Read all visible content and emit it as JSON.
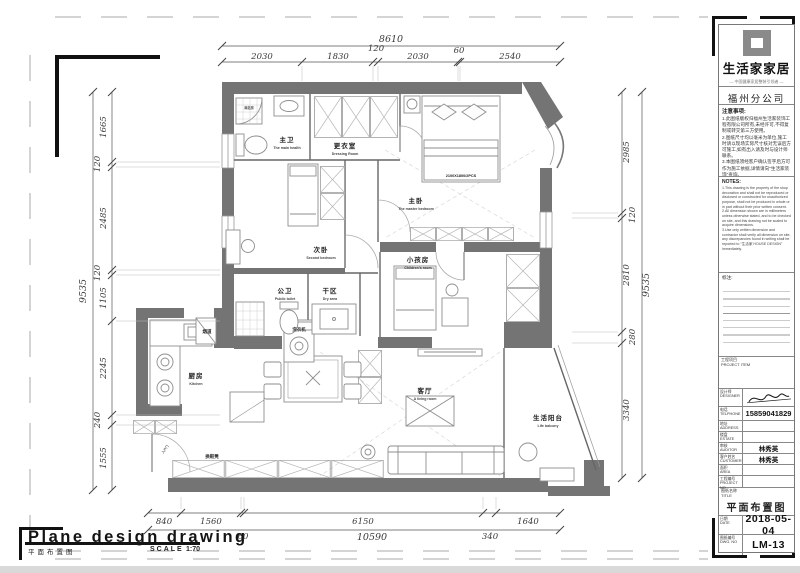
{
  "sheet": {
    "drawing_title_en": "Plane design drawing",
    "drawing_title_cn": "平面布置图",
    "scale_label": "SCALE",
    "scale_value": "1:70"
  },
  "dimensions": {
    "top": {
      "total": "8610",
      "segments": [
        "2030",
        "1830",
        "120",
        "2030",
        "60",
        "2540"
      ]
    },
    "left": {
      "total": "9535",
      "segments": [
        "1665",
        "120",
        "2485",
        "120",
        "1105",
        "2245",
        "240",
        "1555"
      ]
    },
    "right": {
      "total": "9535",
      "segments": [
        "2985",
        "120",
        "2810",
        "280",
        "3340"
      ]
    },
    "bottom": {
      "total": "10590",
      "segments": [
        "840",
        "1560",
        "60",
        "6150",
        "340",
        "1640"
      ]
    }
  },
  "rooms": {
    "master_bath": {
      "cn": "主卫",
      "en": "The main health"
    },
    "dressing": {
      "cn": "更衣室",
      "en": "Dressing Room"
    },
    "master": {
      "cn": "主卧",
      "en": "The master bedroom"
    },
    "second": {
      "cn": "次卧",
      "en": "Second bedroom"
    },
    "children": {
      "cn": "小孩房",
      "en": "Children's room"
    },
    "public_bath": {
      "cn": "公卫",
      "en": "Public toilet"
    },
    "dry_area": {
      "cn": "干区",
      "en": "Dry area"
    },
    "kitchen": {
      "cn": "厨房",
      "en": "Kitchen"
    },
    "living": {
      "cn": "客厅",
      "en": "A living room"
    },
    "balcony": {
      "cn": "生活阳台",
      "en": "Life balcony"
    }
  },
  "plan_labels": {
    "bed_spec": "2100X1800/2PCS",
    "flue": "烟道",
    "washer": "洗衣机",
    "shoe_bench": "换鞋凳",
    "shower": "淋浴房",
    "entry_door": "入户门"
  },
  "titleblock": {
    "brand": "生活家家居",
    "tagline": "— 中国健康家居整装引领者 —",
    "branch": "福州分公司",
    "notes_cn_title": "注意事项:",
    "notes_cn": "1.此图纸版权归福州生活家装饰工程有限公司所有,未经许可,不得复制或转交第三方使用。\n2.图纸尺寸均以毫米为单位,施工时请以现场实际尺寸核对无误后方可施工,如有出入请及时与设计师联系。\n3.本图纸须经客户确认签字后方可作为施工依据,详情请向\"生活家装饰\"查询。",
    "notes_en_title": "NOTES:",
    "notes_en": "1.This drawing is the property of the shop decoration and shall not be reproduced or disclosed or constructed for unauthorized purpose, shall not be produced in whole or in part without their prior written consent.\n2.All dimension shown are in millimeters unless otherwise stated, and to be checked on site, and this drawing not be scaled to acquire dimensions.\n3.Use only written dimension and contractor shall verify all dimension on site, any discrepancies found in writing shall be reported to \"生活家 HOUSE DESIGN\" immediately.",
    "remarks_label": "标注:",
    "project_label": "工程项目\nPROJECT ITEM",
    "designer_label": "设计师\nDESIGNER",
    "phone_label": "电话\nTELPHONE",
    "phone_value": "15859041829",
    "rows": [
      {
        "label": "地址\nADDRESS",
        "value": ""
      },
      {
        "label": "楼盘\nESTATE",
        "value": ""
      },
      {
        "label": "审核\nAUDITOR",
        "value": "林秀英"
      },
      {
        "label": "客户姓名\nCUSTOMER",
        "value": "林秀英"
      },
      {
        "label": "面积\nAREA",
        "value": ""
      },
      {
        "label": "工程编号\nPROJECT NO.",
        "value": ""
      }
    ],
    "title_label": "图纸名称\nTITLE",
    "title_value": "平面布置图",
    "date_label": "日期\nDATE",
    "date_value": "2018-05-04",
    "dwg_label": "图纸编号\nDWG. NO",
    "dwg_value": "LM-13"
  }
}
